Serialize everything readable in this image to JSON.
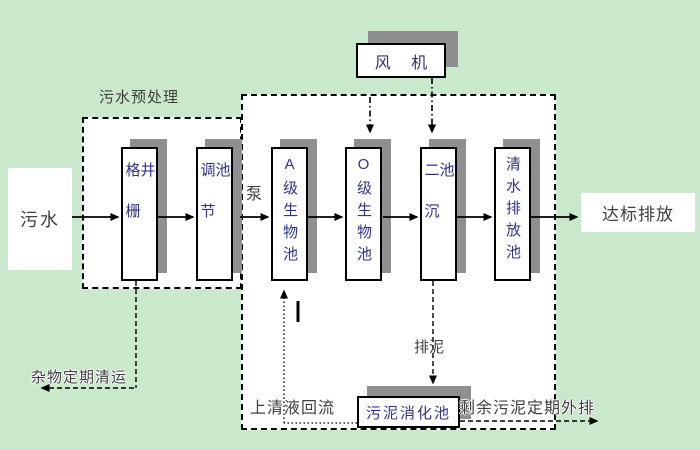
{
  "labels": {
    "pretreatment": "污水预处理",
    "pump": "泵",
    "debris_removal": "杂物定期清运",
    "supernatant_return": "上清液回流",
    "sludge_drain": "排泥",
    "excess_sludge_out": "剩余污泥定期外排"
  },
  "nodes": {
    "influent": "污水",
    "fan": "风 机",
    "grid_well": "格栅井",
    "regulating_tank": "调节池",
    "a_bio_tank": "A级生物池",
    "o_bio_tank": "O级生物池",
    "secondary_clarifier": "二沉池",
    "clean_water_tank": "清水排放池",
    "sludge_digester": "污泥消化池",
    "effluent": "达标排放"
  },
  "colors": {
    "background": "#c9e8cc",
    "tank_text": "#333388",
    "label_text": "#3f3f3f",
    "box_shadow": "#8f8f8f",
    "line": "#000000"
  }
}
